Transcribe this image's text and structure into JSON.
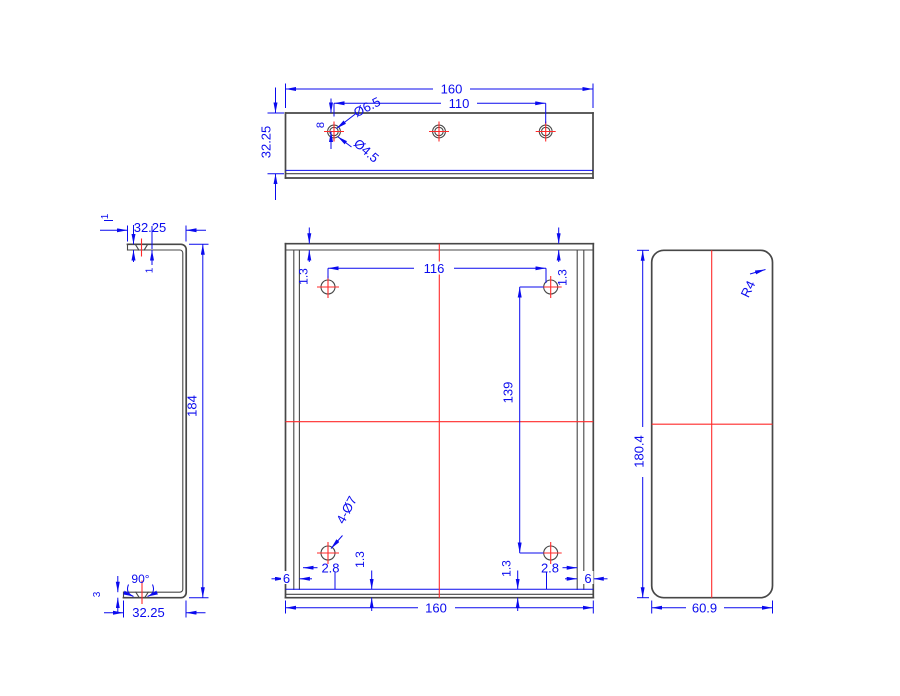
{
  "colors": {
    "dimension_blue": "#0a0aee",
    "centerline_red": "#ff2a2a",
    "outline_gray": "#474747",
    "background": "#ffffff"
  },
  "views": {
    "top": {
      "width": "160",
      "hole_spacing": "110",
      "depth": "32.25",
      "hole_edge_offset": "8",
      "counterbore_dia": "Ø6.5",
      "hole_dia": "Ø4.5"
    },
    "side": {
      "flange_width_top": "32.25",
      "thickness_top": "1",
      "thickness_inner": "1",
      "height": "184",
      "bend_angle": "90°",
      "edge_offset": "3",
      "flange_width_bottom": "32.25"
    },
    "front": {
      "hole_spacing_x": "116",
      "hole_spacing_y": "139",
      "offset_top_left": "1.3",
      "offset_top_right": "1.3",
      "offset_bottom_left": "1.3",
      "offset_bottom_right": "1.3",
      "hole_edge_left": "2.8",
      "hole_edge_right": "2.8",
      "flange_left": "6",
      "flange_right": "6",
      "width": "160",
      "holes_note": "4-Ø7"
    },
    "right": {
      "corner_radius": "R4",
      "height": "180.4",
      "width": "60.9"
    }
  }
}
